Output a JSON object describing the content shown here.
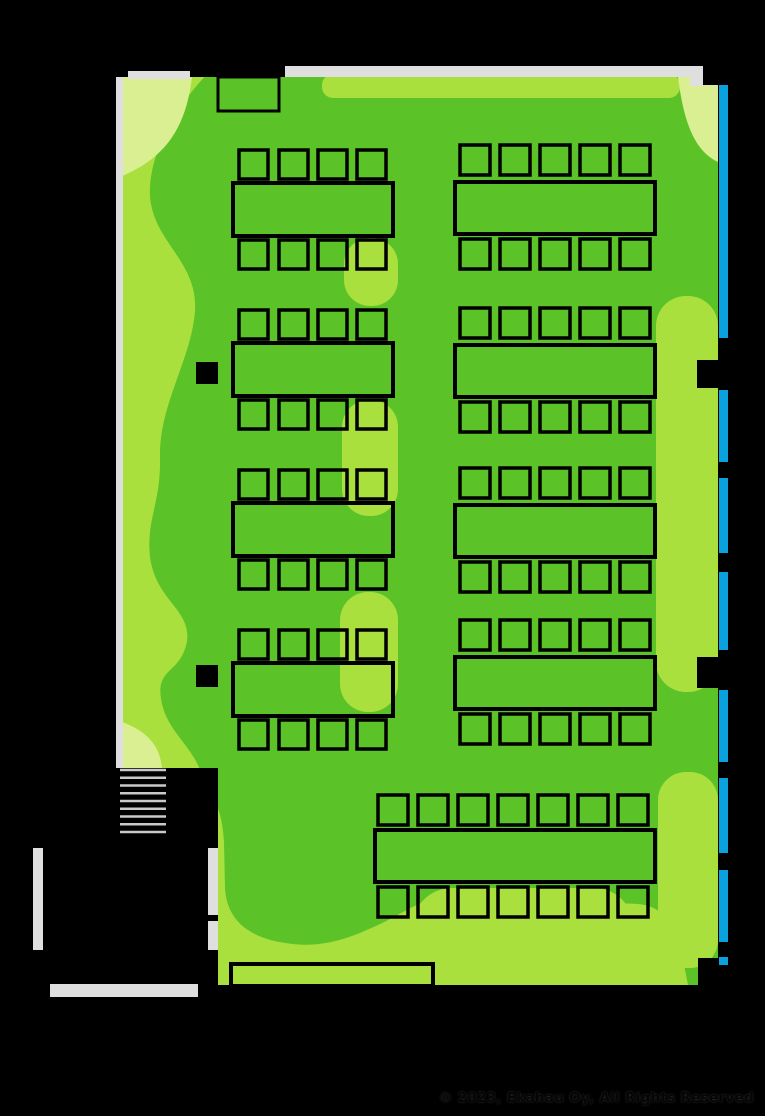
{
  "meta": {
    "view": "wifi-coverage-heatmap-floorplan",
    "canvas": {
      "width": 765,
      "height": 1116
    },
    "background_color": "#000000"
  },
  "footer": {
    "copyright": "© 2023, Ekahau Oy, All Rights Reserved",
    "text_color": "#050505"
  },
  "heatmap": {
    "levels": [
      {
        "name": "signal-strong",
        "color": "#5BC328"
      },
      {
        "name": "signal-medium",
        "color": "#A9E03E"
      },
      {
        "name": "signal-weak",
        "color": "#D9EF92"
      }
    ],
    "wall_color": "#DFDFDF",
    "stair_color": "#C9C9C9",
    "window_color": "#09A2DE",
    "outline_color": "#000000",
    "room_path": "M122,77 L718,77 L718,958 L700,958 L700,985 L218,985 L218,768 L122,768 Z",
    "strong_region_path": "M215,66 L718,66 L718,985 L688,985 C682,952 676,928 662,914 C646,898 618,906 598,903 C568,899 558,891 528,894 C498,897 468,889 448,894 C418,901 398,916 378,925 C356,935 328,948 293,944 C254,940 227,924 225,888 L224,842 C222,806 212,796 202,776 C194,746 166,732 161,699 C156,667 181,674 187,641 C191,609 156,601 150,557 C146,519 161,504 160,457 C159,404 191,361 195,311 C198,261 153,242 150,196 C148,158 172,108 215,66 Z",
    "medium_patches": [
      {
        "x": 322,
        "y": 74,
        "w": 358,
        "h": 24,
        "rx": 11
      },
      {
        "x": 344,
        "y": 238,
        "w": 54,
        "h": 68,
        "rx": 26
      },
      {
        "x": 342,
        "y": 400,
        "w": 56,
        "h": 116,
        "rx": 27
      },
      {
        "x": 340,
        "y": 592,
        "w": 58,
        "h": 120,
        "rx": 28
      },
      {
        "x": 656,
        "y": 296,
        "w": 62,
        "h": 396,
        "rx": 30
      },
      {
        "x": 658,
        "y": 772,
        "w": 60,
        "h": 196,
        "rx": 28
      },
      {
        "x": 412,
        "y": 888,
        "w": 222,
        "h": 110,
        "rx": 40
      }
    ],
    "weak_patches": [
      "M122,77 L192,77 C186,128 165,158 122,176 Z",
      "M678,77 L718,77 L718,162 C692,150 683,116 678,77 Z",
      "M122,722 C152,733 160,750 162,768 L122,768 Z"
    ]
  },
  "floorplan": {
    "walls": [
      {
        "x": 128,
        "y": 71,
        "w": 62,
        "h": 8
      },
      {
        "x": 285,
        "y": 66,
        "w": 418,
        "h": 11
      },
      {
        "x": 690,
        "y": 66,
        "w": 13,
        "h": 20
      },
      {
        "x": 116,
        "y": 77,
        "w": 7,
        "h": 691
      },
      {
        "x": 33,
        "y": 848,
        "w": 10,
        "h": 102
      },
      {
        "x": 208,
        "y": 848,
        "w": 10,
        "h": 67
      },
      {
        "x": 208,
        "y": 921,
        "w": 10,
        "h": 29
      },
      {
        "x": 50,
        "y": 984,
        "w": 148,
        "h": 13
      }
    ],
    "black_notches": [
      {
        "x": 703,
        "y": 66,
        "w": 16,
        "h": 19
      },
      {
        "x": 698,
        "y": 958,
        "w": 30,
        "h": 28
      }
    ],
    "pillars": [
      {
        "x": 196,
        "y": 362,
        "w": 22,
        "h": 22
      },
      {
        "x": 196,
        "y": 665,
        "w": 22,
        "h": 22
      },
      {
        "x": 697,
        "y": 360,
        "w": 22,
        "h": 28
      },
      {
        "x": 697,
        "y": 657,
        "w": 22,
        "h": 31
      }
    ],
    "windows": {
      "x": 719,
      "w": 9,
      "segments": [
        [
          85,
          338
        ],
        [
          390,
          462
        ],
        [
          478,
          553
        ],
        [
          572,
          650
        ],
        [
          690,
          762
        ],
        [
          778,
          853
        ],
        [
          870,
          942
        ],
        [
          957,
          965
        ]
      ]
    },
    "stairs": {
      "x": 120,
      "w": 46,
      "y_start": 770,
      "line_count": 9,
      "spacing": 7.75,
      "thickness": 2.6
    },
    "door": {
      "x": 218,
      "y": 77,
      "w": 61,
      "h": 34
    },
    "board": {
      "x": 231,
      "y": 964,
      "w": 202,
      "h": 22
    },
    "left_tables": {
      "x": 233,
      "w": 160,
      "h": 53,
      "ys": [
        183,
        343,
        503,
        663
      ],
      "chair_xs": [
        239,
        279,
        318,
        357
      ],
      "chair_w": 29,
      "chair_h": 29,
      "top_dy": -33,
      "bot_dy": 4
    },
    "right_tables": {
      "x": 455,
      "w": 200,
      "h": 52,
      "ys": [
        182,
        345,
        505,
        657
      ],
      "chair_xs": [
        460,
        500,
        540,
        580,
        620
      ],
      "chair_w": 30,
      "chair_h": 30,
      "top_dy": -37,
      "bot_dy": 5
    },
    "bottom_table": {
      "x": 375,
      "y": 830,
      "w": 280,
      "h": 52,
      "chair_xs": [
        378,
        418,
        458,
        498,
        538,
        578,
        618
      ],
      "chair_w": 30,
      "chair_h": 30,
      "chair_top_y": 795,
      "chair_bot_y": 887
    }
  }
}
